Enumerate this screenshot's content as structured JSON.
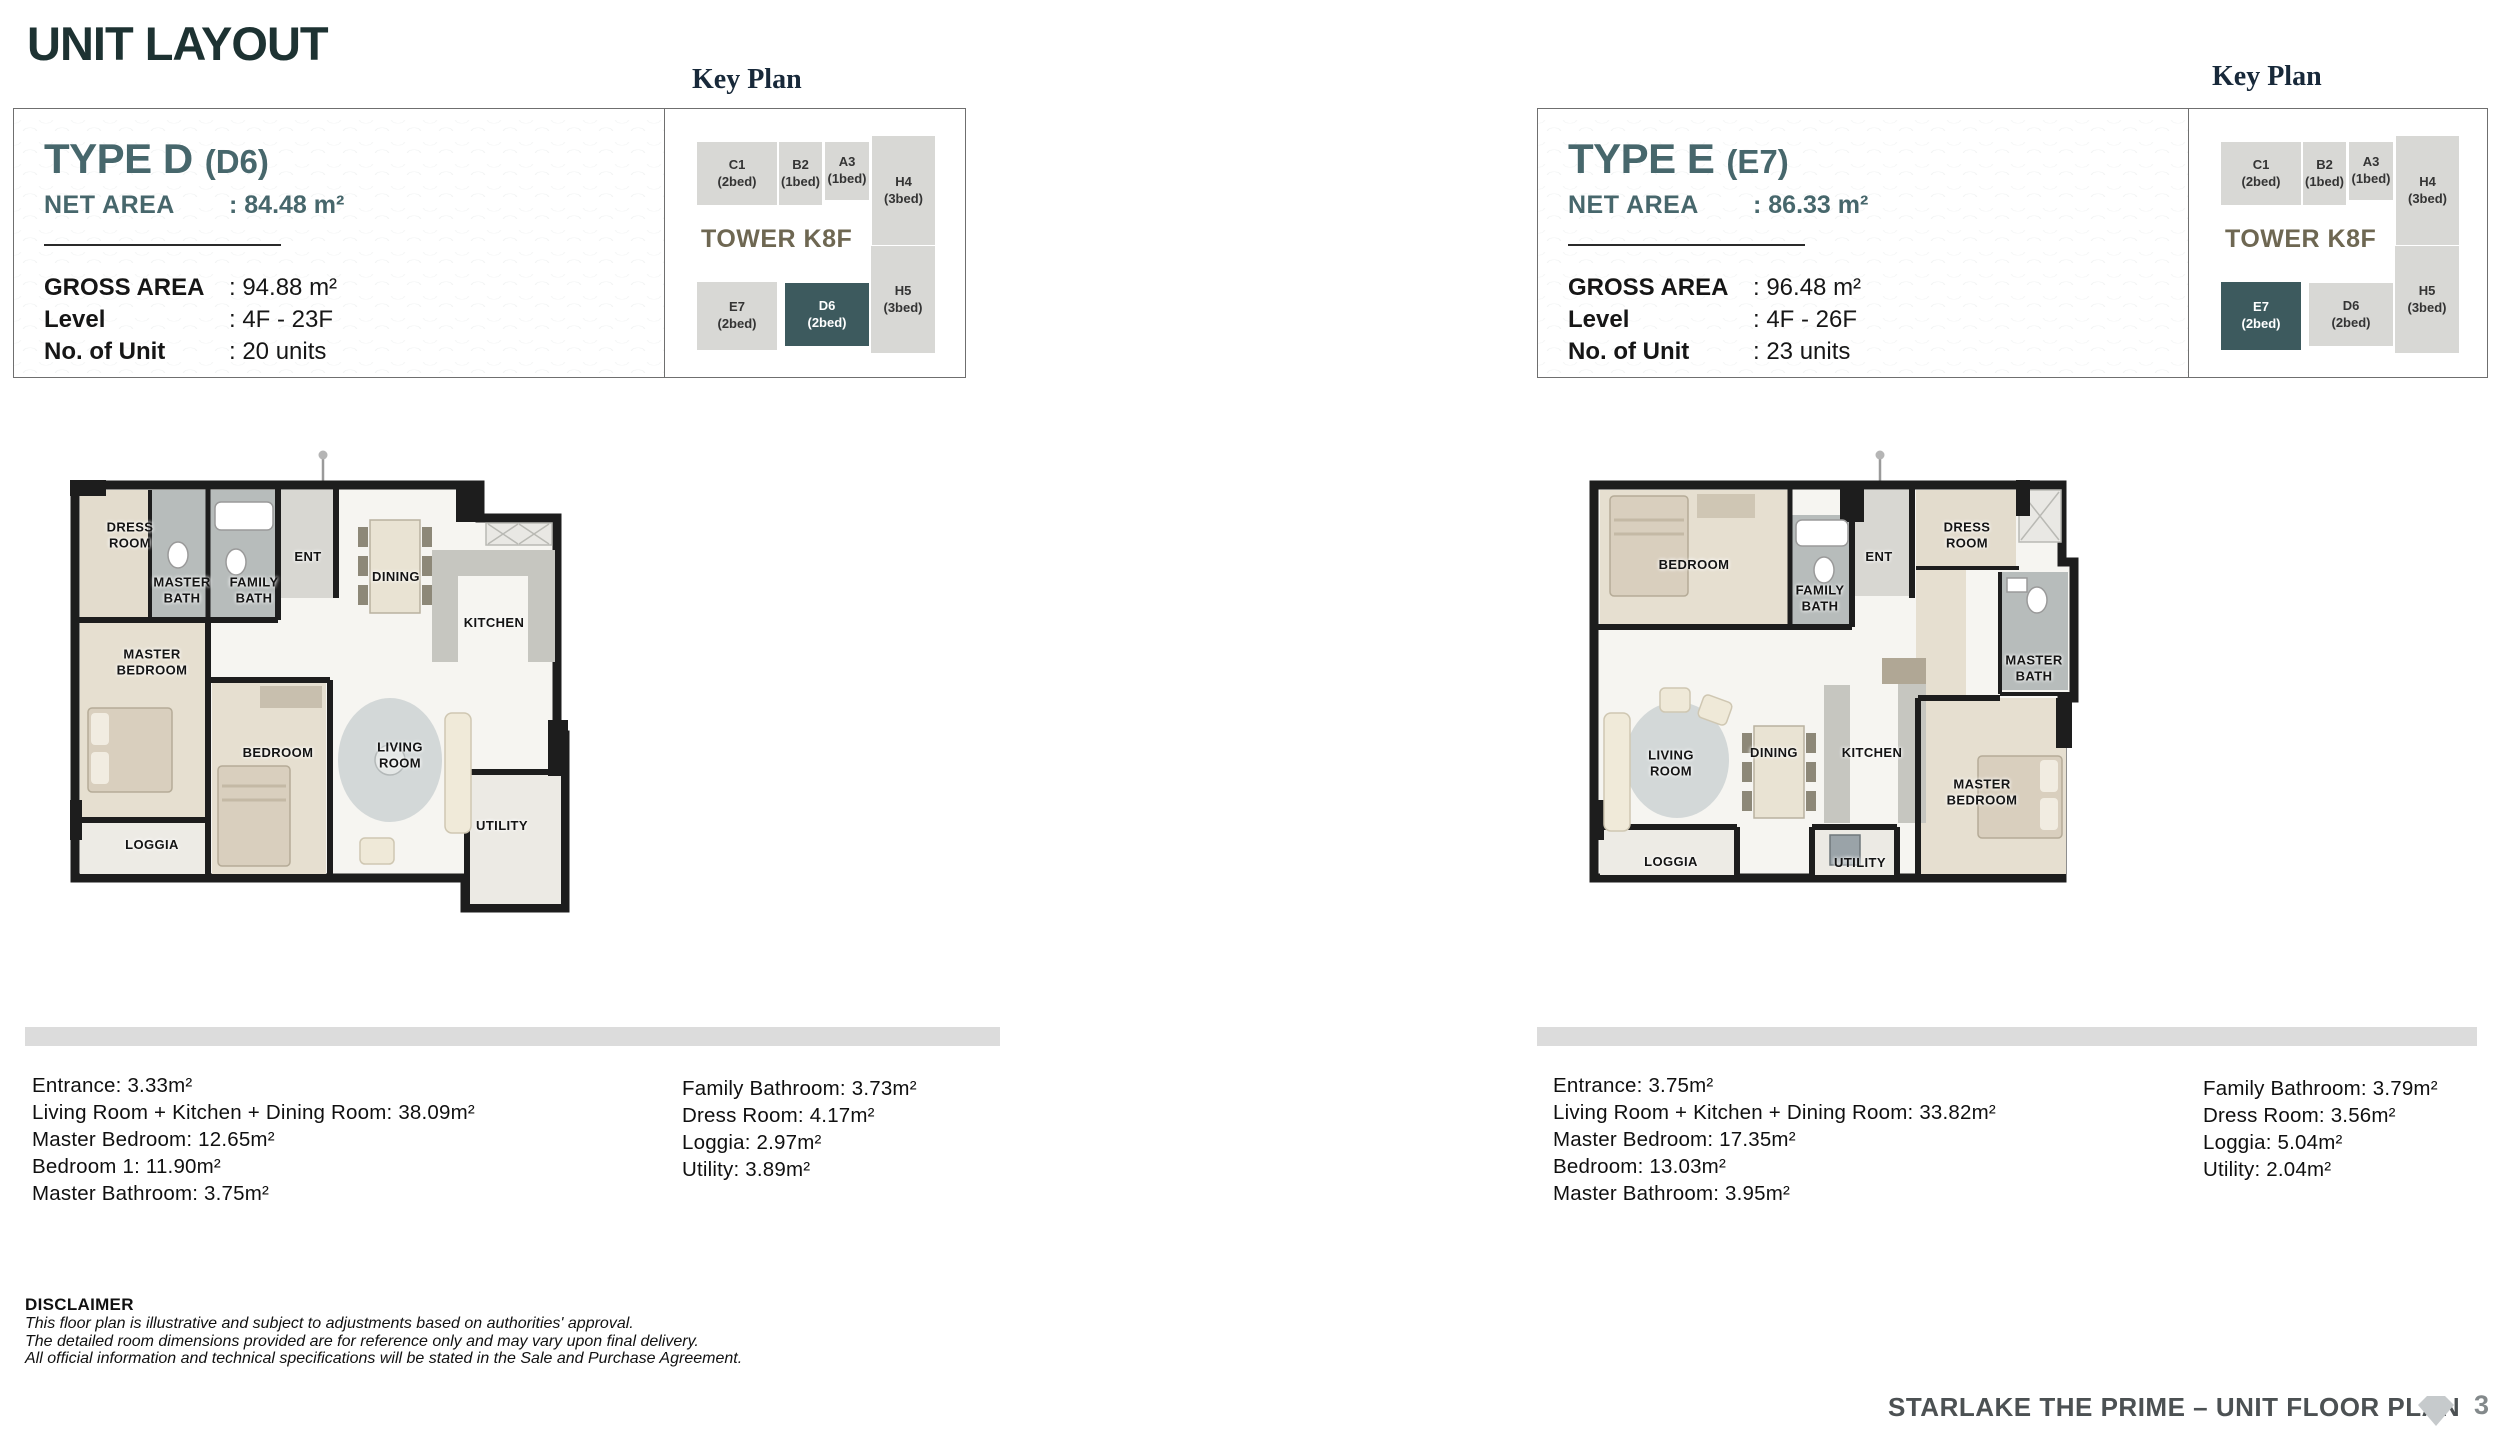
{
  "page": {
    "title": "UNIT LAYOUT",
    "footer_text": "STARLAKE THE PRIME – UNIT FLOOR PLAN",
    "page_number": "3"
  },
  "key_plan": {
    "heading": "Key Plan",
    "tower": "TOWER K8F",
    "units": [
      {
        "code": "C1",
        "beds": "(2bed)"
      },
      {
        "code": "B2",
        "beds": "(1bed)"
      },
      {
        "code": "A3",
        "beds": "(1bed)"
      },
      {
        "code": "H4",
        "beds": "(3bed)"
      },
      {
        "code": "E7",
        "beds": "(2bed)"
      },
      {
        "code": "D6",
        "beds": "(2bed)"
      },
      {
        "code": "H5",
        "beds": "(3bed)"
      }
    ],
    "colors": {
      "highlight": "#3d5a5e",
      "cell": "#d8d8d5"
    }
  },
  "type_d": {
    "title": "TYPE D",
    "code": "(D6)",
    "net_area_label": "NET AREA",
    "net_area_value": ": 84.48 m²",
    "details": [
      {
        "label": "GROSS AREA",
        "value": ": 94.88 m²"
      },
      {
        "label": "Level",
        "value": ": 4F - 23F"
      },
      {
        "label": "No. of Unit",
        "value": ": 20 units"
      }
    ],
    "highlight_unit": "D6",
    "plan_rooms": [
      "DRESS ROOM",
      "MASTER BATH",
      "FAMILY BATH",
      "ENT",
      "DINING",
      "KITCHEN",
      "MASTER BEDROOM",
      "BEDROOM",
      "LIVING ROOM",
      "LOGGIA",
      "UTILITY"
    ],
    "areas_col1": [
      "Entrance: 3.33m²",
      "Living Room + Kitchen + Dining Room: 38.09m²",
      "Master Bedroom: 12.65m²",
      "Bedroom 1: 11.90m²",
      "Master Bathroom: 3.75m²"
    ],
    "areas_col2": [
      "Family Bathroom: 3.73m²",
      "Dress Room: 4.17m²",
      "Loggia: 2.97m²",
      "Utility: 3.89m²"
    ]
  },
  "type_e": {
    "title": "TYPE E",
    "code": "(E7)",
    "net_area_label": "NET AREA",
    "net_area_value": ": 86.33 m²",
    "details": [
      {
        "label": "GROSS AREA",
        "value": ": 96.48 m²"
      },
      {
        "label": "Level",
        "value": ": 4F - 26F"
      },
      {
        "label": "No. of Unit",
        "value": ": 23 units"
      }
    ],
    "highlight_unit": "E7",
    "plan_rooms": [
      "BEDROOM",
      "FAMILY BATH",
      "ENT",
      "DRESS ROOM",
      "MASTER BATH",
      "LIVING ROOM",
      "DINING",
      "KITCHEN",
      "MASTER BEDROOM",
      "LOGGIA",
      "UTILITY"
    ],
    "areas_col1": [
      "Entrance: 3.75m²",
      "Living Room + Kitchen + Dining Room: 33.82m²",
      "Master Bedroom: 17.35m²",
      "Bedroom: 13.03m²",
      "Master Bathroom: 3.95m²"
    ],
    "areas_col2": [
      "Family Bathroom: 3.79m²",
      "Dress Room: 3.56m²",
      "Loggia: 5.04m²",
      "Utility: 2.04m²"
    ]
  },
  "disclaimer": {
    "heading": "DISCLAIMER",
    "lines": [
      "This floor plan is illustrative and subject to adjustments based on authorities' approval.",
      "The detailed room dimensions provided are for reference only and may vary upon final delivery.",
      "All official information and technical specifications will be stated in the Sale and Purchase Agreement."
    ]
  }
}
